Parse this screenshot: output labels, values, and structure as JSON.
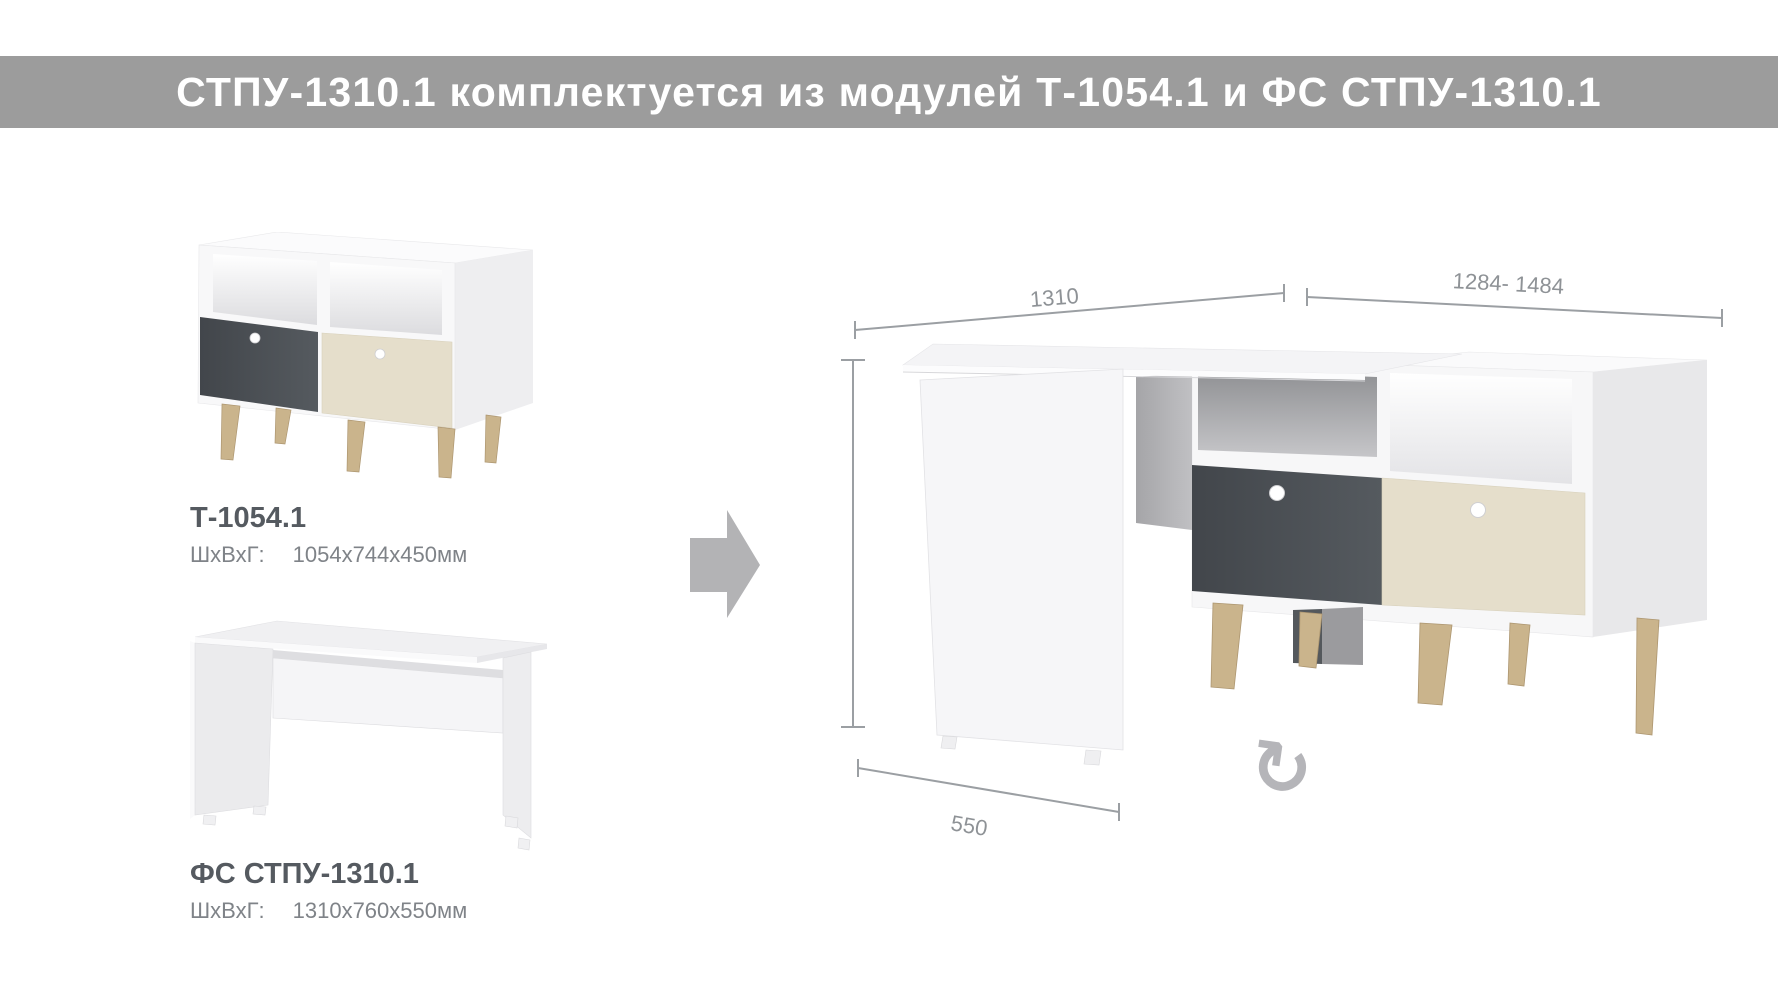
{
  "banner": {
    "text": "СТПУ-1310.1 комплектуется из модулей Т-1054.1 и ФС СТПУ-1310.1"
  },
  "modules": [
    {
      "title": "Т-1054.1",
      "dims_label": "ШхВхГ:",
      "dims_value": "1054х744х450мм"
    },
    {
      "title": "ФС СТПУ-1310.1",
      "dims_label": "ШхВхГ:",
      "dims_value": "1310х760х550мм"
    }
  ],
  "assembled": {
    "dim_top_left": "1310",
    "dim_top_right": "1284- 1484",
    "dim_bottom": "550"
  },
  "icons": {
    "combine_arrow": "right-block-arrow",
    "rotate_clockwise": "↻"
  },
  "colors": {
    "banner_bg": "#9c9c9c",
    "banner_text": "#ffffff",
    "module_title": "#555a60",
    "module_dims": "#7f8388",
    "dimension_lines": "#9b9fa3",
    "drawer_dark": "#4a4e53",
    "drawer_beige": "#e5decb",
    "legs_wood": "#cab48c",
    "arrow": "#b3b3b5"
  }
}
